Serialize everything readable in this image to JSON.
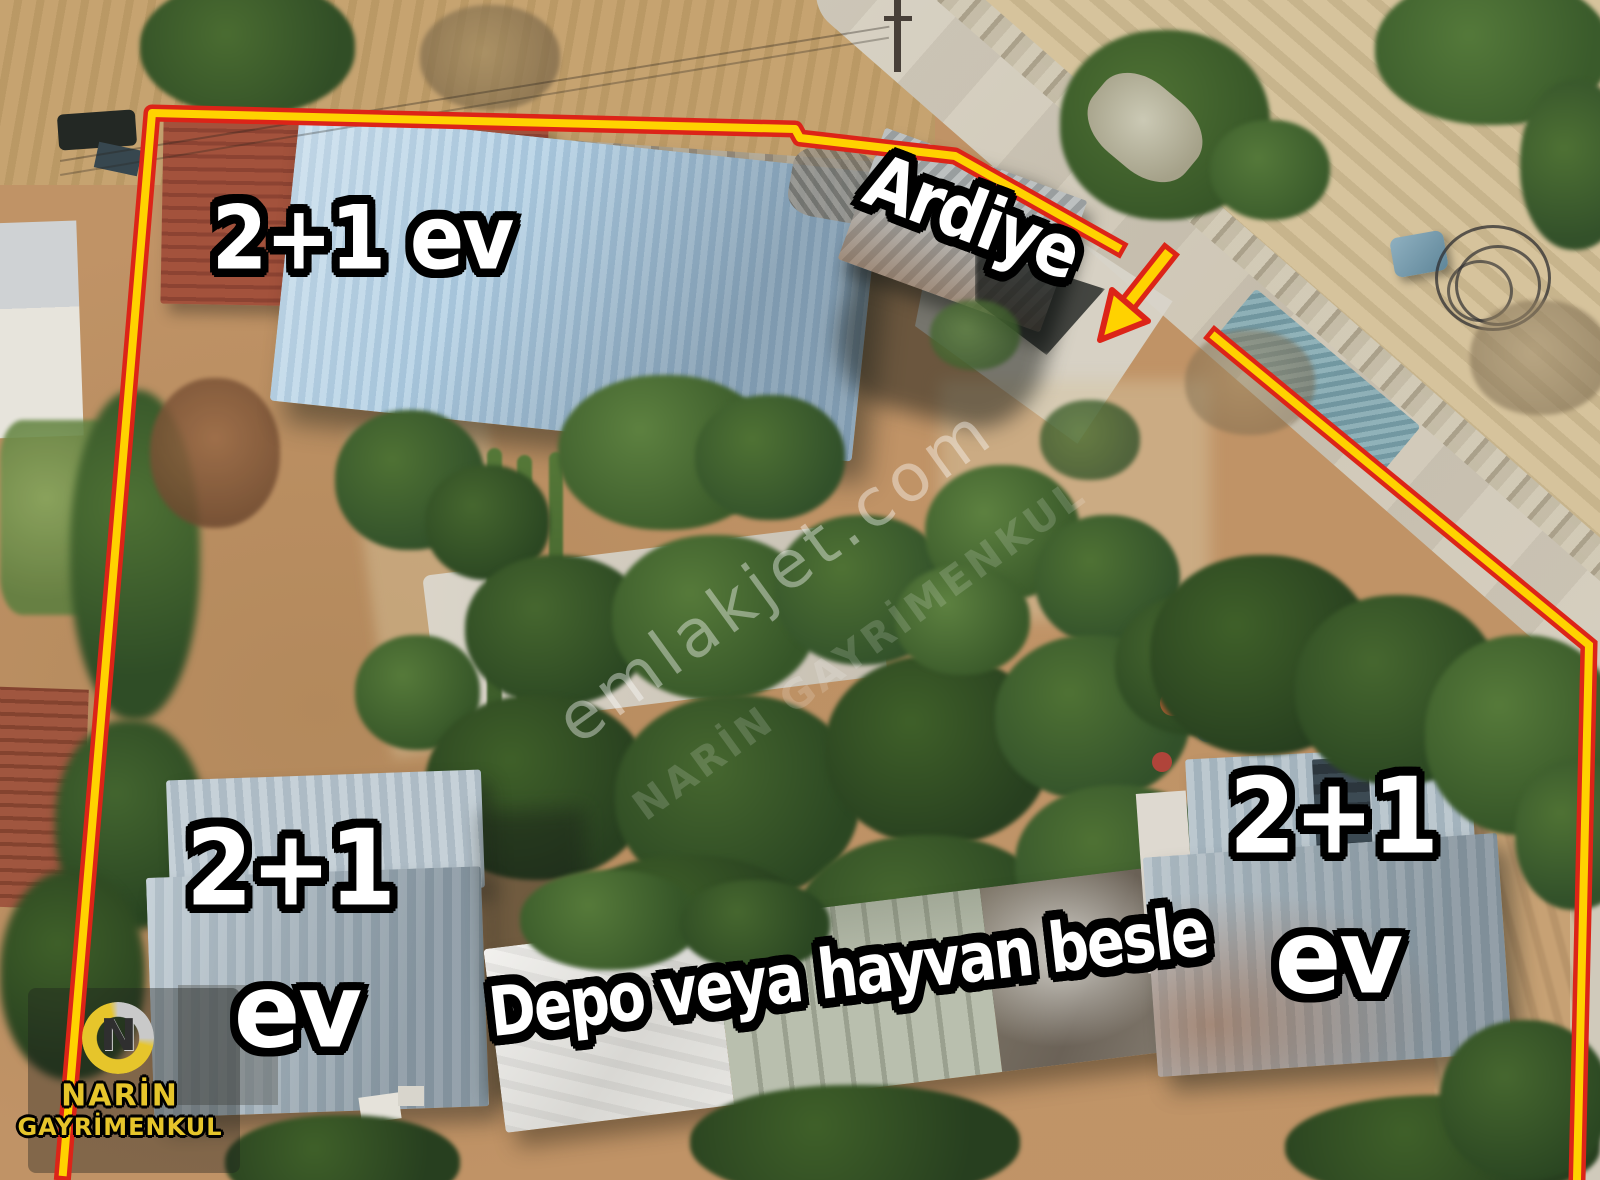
{
  "annotations": {
    "top_left_house": "2+1 ev",
    "storage_shed": "Ardiye",
    "bottom_left_house_line1": "2+1",
    "bottom_left_house_line2": "ev",
    "right_house_line1": "2+1",
    "right_house_line2": "ev",
    "barn": "Depo veya hayvan besle"
  },
  "watermarks": {
    "primary": "emlakjet.com",
    "secondary": "NARİN GAYRİMENKUL"
  },
  "logo": {
    "monogram": "N",
    "name_line1": "NARİN",
    "name_line2": "GAYRİMENKUL"
  },
  "colors": {
    "boundary_yellow": "#FFD200",
    "boundary_red": "#DC2418",
    "label_fill": "#FFFFFF",
    "label_outline": "#000000",
    "logo_yellow": "#E6C52B"
  }
}
